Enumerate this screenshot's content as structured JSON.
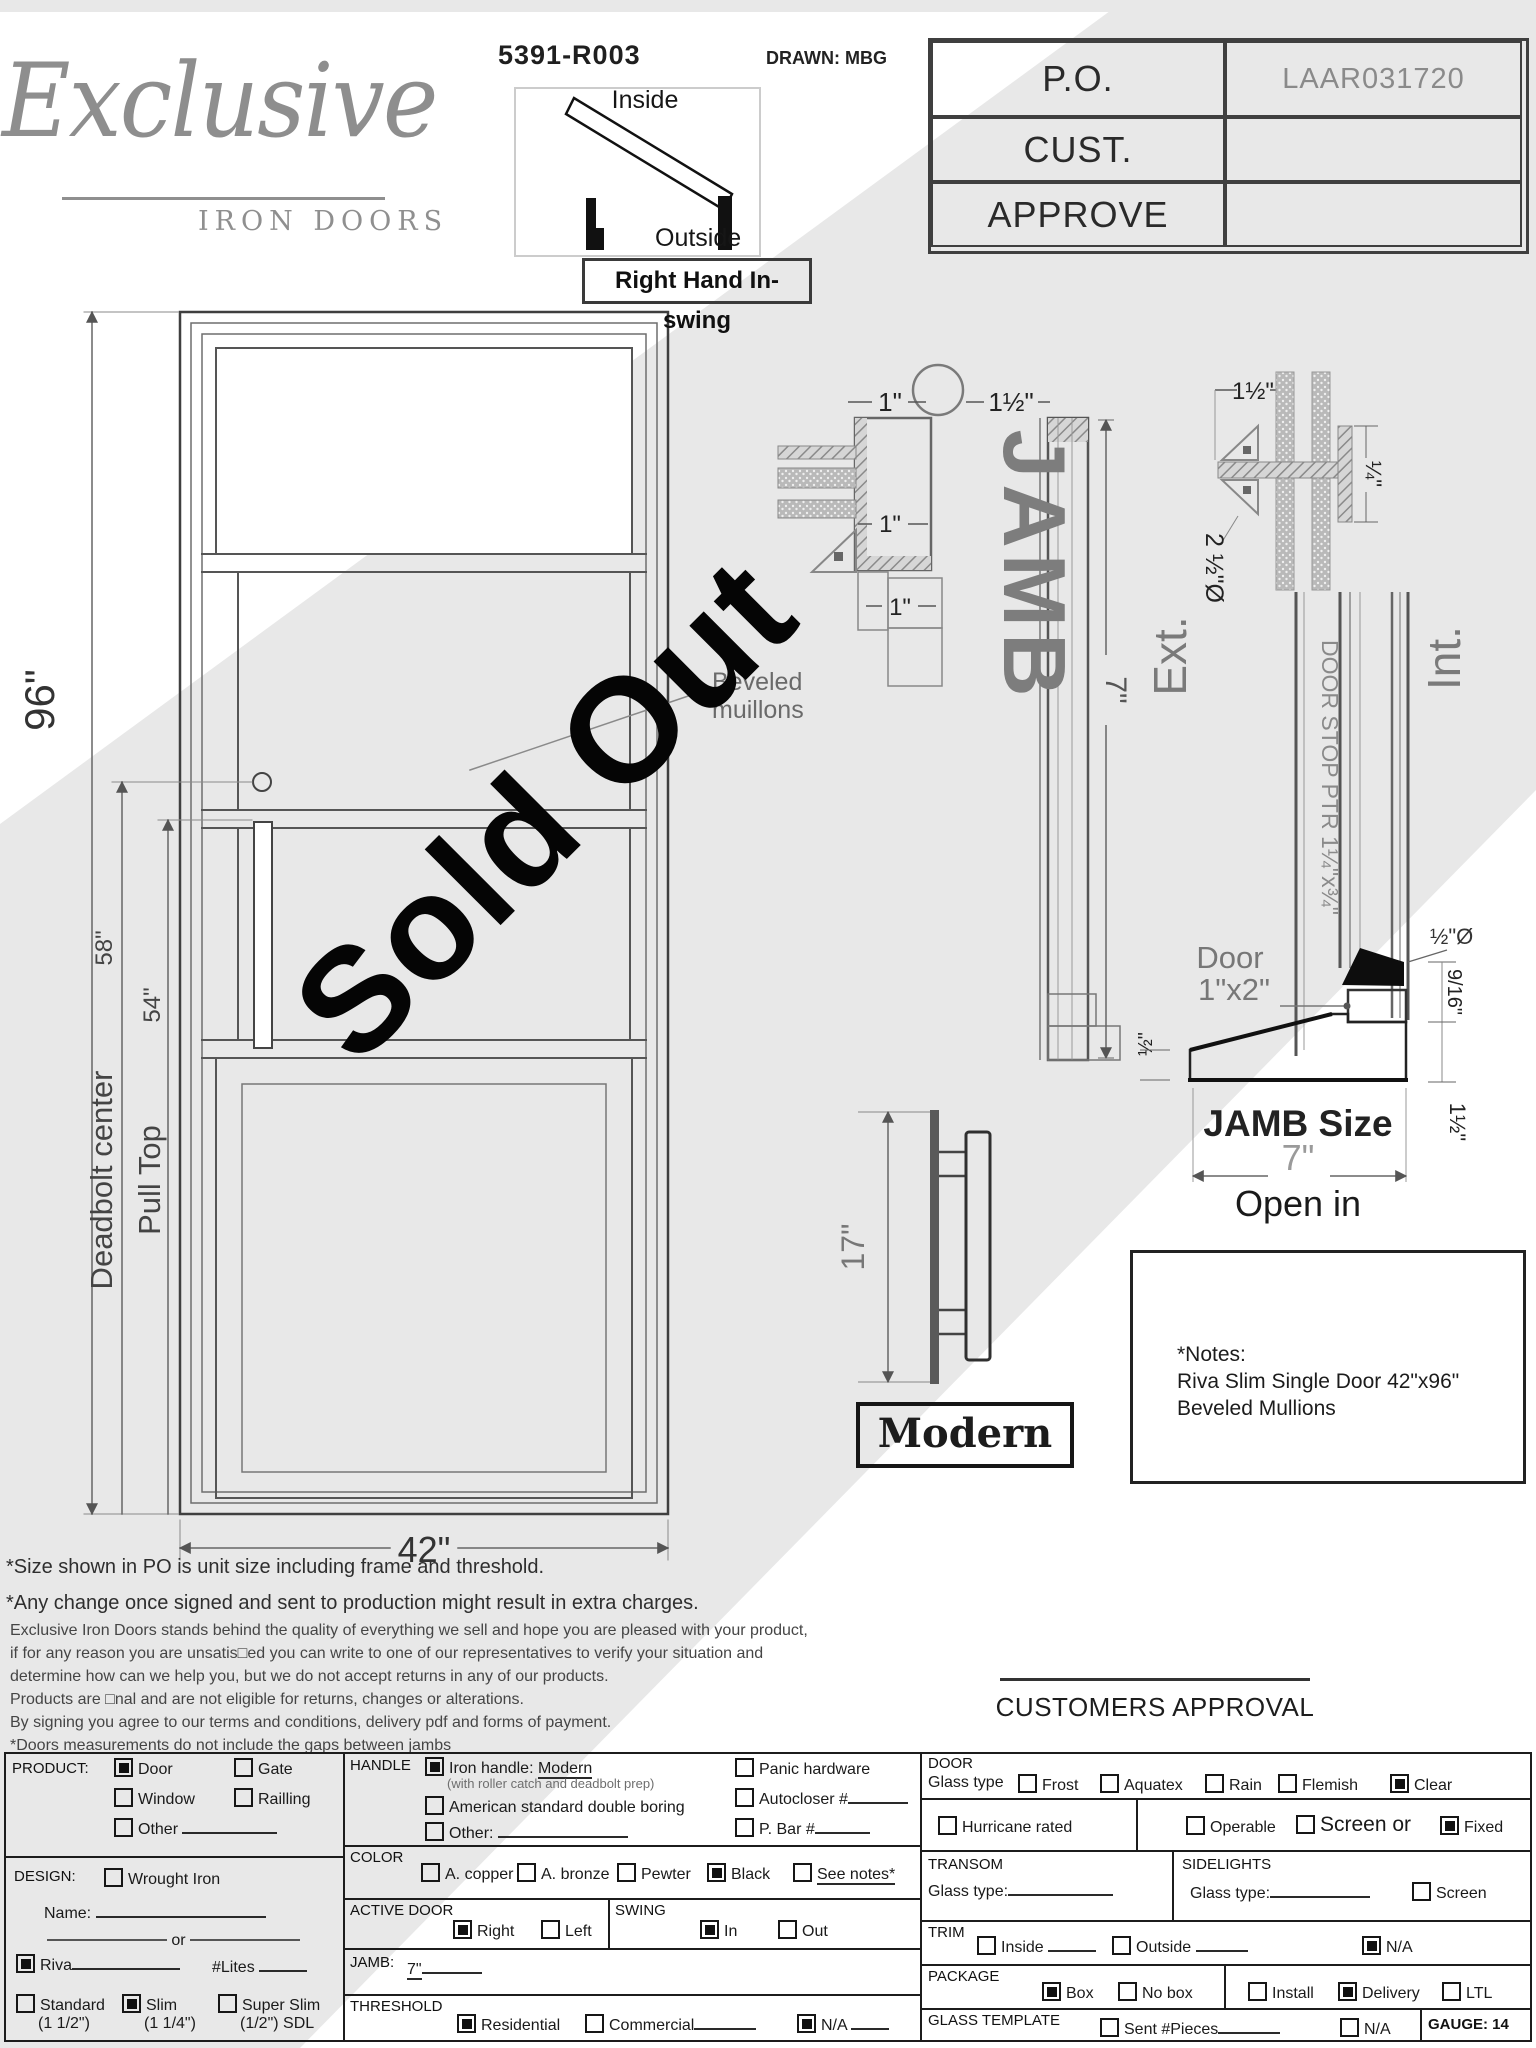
{
  "header": {
    "logo_script": "Exclusive",
    "logo_sub": "IRON DOORS",
    "drawing_number": "5391-R003",
    "drawn_by": "DRAWN: MBG",
    "swing": {
      "inside": "Inside",
      "outside": "Outside",
      "caption": "Right Hand In-swing"
    },
    "po_table": {
      "rows": [
        {
          "label": "P.O.",
          "value": "LAAR031720"
        },
        {
          "label": "CUST.",
          "value": ""
        },
        {
          "label": "APPROVE",
          "value": ""
        }
      ]
    }
  },
  "watermark": "Sold Out",
  "door_drawing": {
    "height_dim": "96\"",
    "deadbolt_label": "Deadbolt center",
    "deadbolt_value": "58\"",
    "pull_label": "Pull Top",
    "pull_value": "54\"",
    "width_dim": "42\"",
    "callout_line1": "Beveled",
    "callout_line2": "muillons"
  },
  "jamb_drawing": {
    "dim_1": "1\"",
    "dim_1_5": "1½\"",
    "dim_1b": "1\"",
    "dim_1c": "1\"",
    "title": "JAMB",
    "dim_7": "7\""
  },
  "section_drawing": {
    "dim_1_5": "1½\"",
    "dim_quarter": "¼\"",
    "dim_2half_dia": "2 ½\"Ø",
    "ext": "Ext.",
    "int": "Int.",
    "door_stop": "DOOR STOP PTR 1¼\"x¾\"",
    "door_label_1": "Door",
    "door_label_2": "1\"x2\"",
    "dim_half": "½\"",
    "dim_half_dia": "½\"Ø",
    "dim_9_16": "9/16\"",
    "dim_1_1_2": "1½\"",
    "jamb_size_label": "JAMB Size",
    "jamb_size_value": "7\"",
    "open_label": "Open in"
  },
  "handle_drawing": {
    "dim": "17\"",
    "caption": "Modern"
  },
  "notes": {
    "line1": "*Notes:",
    "line2": "Riva Slim Single Door 42\"x96\"",
    "line3": "Beveled Mullions"
  },
  "disclaimer": {
    "line1": "*Size shown in PO is unit size including frame and threshold.",
    "line2": "*Any change once signed and sent to production might result in extra charges.",
    "line3": "Exclusive Iron Doors stands behind the quality of everything we sell and hope you are pleased with your product,",
    "line4": "if for any reason you are unsatis□ed you can write to one of our representatives to verify your situation and",
    "line5": "determine how can we help you, but we do not accept returns in any of our products.",
    "line6": "Products are □nal and are not eligible for returns, changes or alterations.",
    "line7": "By signing you agree to our terms and conditions, delivery pdf and forms of payment.",
    "line8": "*Doors measurements do not include the gaps between jambs"
  },
  "approval": {
    "label": "CUSTOMERS APPROVAL"
  },
  "form": {
    "product": {
      "title": "PRODUCT:",
      "door": {
        "label": "Door",
        "checked": true
      },
      "gate": {
        "label": "Gate",
        "checked": false
      },
      "window": {
        "label": "Window",
        "checked": false
      },
      "railing": {
        "label": "Railling",
        "checked": false
      },
      "other": {
        "label": "Other",
        "checked": false
      }
    },
    "design": {
      "title": "DESIGN:",
      "wrought": {
        "label": "Wrought Iron",
        "checked": false
      },
      "name_label": "Name:",
      "or_label": "or",
      "riva": {
        "label": "Riva",
        "checked": true
      },
      "lites_label": "#Lites",
      "standard": {
        "label": "Standard",
        "sub": "(1 1/2\")",
        "checked": false
      },
      "slim": {
        "label": "Slim",
        "sub": "(1 1/4\")",
        "checked": true
      },
      "super_slim": {
        "label": "Super Slim",
        "sub": "(1/2\") SDL",
        "checked": false
      }
    },
    "handle": {
      "title": "HANDLE",
      "iron": {
        "label": "Iron handle:",
        "value": "Modern",
        "checked": true
      },
      "sub": "(with roller catch and deadbolt prep)",
      "american": {
        "label": "American standard double boring",
        "checked": false
      },
      "other": {
        "label": "Other:",
        "checked": false
      },
      "panic": {
        "label": "Panic hardware",
        "checked": false
      },
      "autocloser": {
        "label": "Autocloser #",
        "checked": false
      },
      "pbar": {
        "label": "P. Bar #",
        "checked": false
      }
    },
    "color": {
      "title": "COLOR",
      "copper": {
        "label": "A. copper",
        "checked": false
      },
      "bronze": {
        "label": "A. bronze",
        "checked": false
      },
      "pewter": {
        "label": "Pewter",
        "checked": false
      },
      "black": {
        "label": "Black",
        "checked": true
      },
      "see_notes": {
        "label": "See notes*",
        "checked": false
      }
    },
    "active_door": {
      "title": "ACTIVE DOOR",
      "right": {
        "label": "Right",
        "checked": true
      },
      "left": {
        "label": "Left",
        "checked": false
      }
    },
    "swing_row": {
      "title": "SWING",
      "in": {
        "label": "In",
        "checked": true
      },
      "out": {
        "label": "Out",
        "checked": false
      }
    },
    "jamb_row": {
      "title": "JAMB:",
      "value": "7\""
    },
    "threshold": {
      "title": "THRESHOLD",
      "residential": {
        "label": "Residential",
        "checked": true
      },
      "commercial": {
        "label": "Commercial",
        "checked": false
      },
      "na": {
        "label": "N/A",
        "checked": true
      }
    },
    "door_sec": {
      "title": "DOOR",
      "glass_label": "Glass type",
      "frost": {
        "label": "Frost",
        "checked": false
      },
      "aquatex": {
        "label": "Aquatex",
        "checked": false
      },
      "rain": {
        "label": "Rain",
        "checked": false
      },
      "flemish": {
        "label": "Flemish",
        "checked": false
      },
      "clear": {
        "label": "Clear",
        "checked": true
      }
    },
    "hurricane": {
      "label": "Hurricane rated",
      "checked": false
    },
    "operable_row": {
      "operable": {
        "label": "Operable",
        "checked": false
      },
      "screen_or": {
        "label": "Screen or",
        "checked": false
      },
      "fixed": {
        "label": "Fixed",
        "checked": true
      }
    },
    "transom": {
      "title": "TRANSOM",
      "glass_label": "Glass type:"
    },
    "sidelights": {
      "title": "SIDELIGHTS",
      "glass_label": "Glass type:",
      "screen": {
        "label": "Screen",
        "checked": false
      }
    },
    "trim": {
      "title": "TRIM",
      "inside": {
        "label": "Inside",
        "checked": false
      },
      "outside": {
        "label": "Outside",
        "checked": false
      },
      "na": {
        "label": "N/A",
        "checked": true
      }
    },
    "package": {
      "title": "PACKAGE",
      "box": {
        "label": "Box",
        "checked": true
      },
      "nobox": {
        "label": "No box",
        "checked": false
      },
      "install": {
        "label": "Install",
        "checked": false
      },
      "delivery": {
        "label": "Delivery",
        "checked": true
      },
      "ltl": {
        "label": "LTL",
        "checked": false
      }
    },
    "glass_template": {
      "title": "GLASS TEMPLATE",
      "sent": {
        "label": "Sent #Pieces",
        "checked": false
      },
      "na": {
        "label": "N/A",
        "checked": false
      }
    },
    "gauge": "GAUGE: 14"
  }
}
